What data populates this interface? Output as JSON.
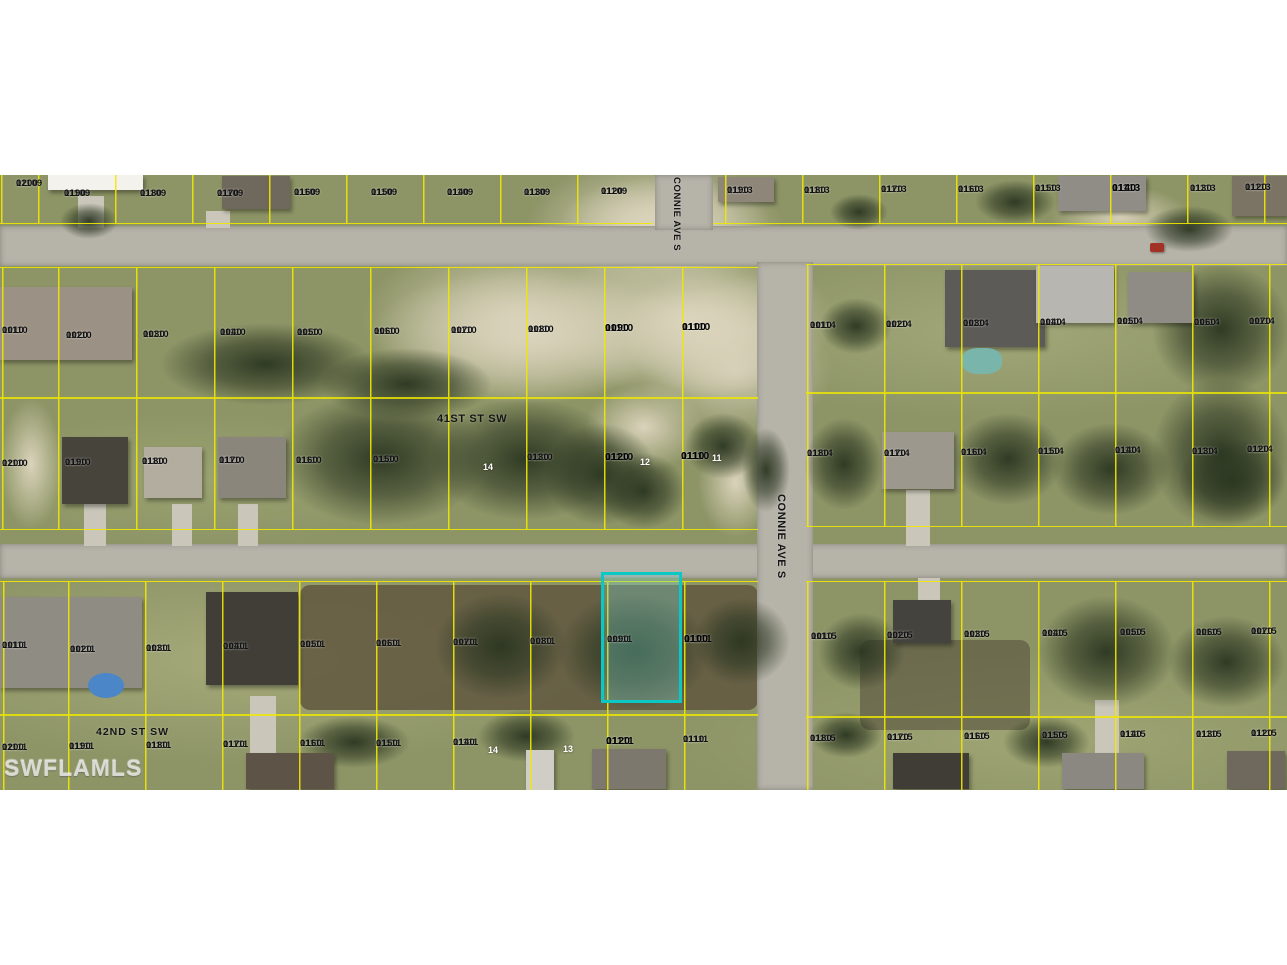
{
  "watermark": "SWFLAMLS",
  "streets": [
    {
      "name": "41ST ST SW"
    },
    {
      "name": "42ND ST SW"
    },
    {
      "name": "CONNIE AVE S"
    },
    {
      "name": "CONNIE AVE S"
    }
  ],
  "highlighted_parcel": {
    "id": "11110 0120",
    "outline_color": "#0bc8c4"
  },
  "colors": {
    "parcel_line": "#f0e900",
    "highlight": "#0bc8c4",
    "label_text": "#101010",
    "road": "#b6b3a9",
    "watermark_text": "#e6e6e0"
  },
  "parcels": [
    {
      "id": "11109 0200",
      "x": 16,
      "y": 179
    },
    {
      "id": "11109 0190",
      "x": 64,
      "y": 189
    },
    {
      "id": "11109 0180",
      "x": 140,
      "y": 189
    },
    {
      "id": "11109 0170",
      "x": 217,
      "y": 189
    },
    {
      "id": "11109 0160",
      "x": 294,
      "y": 188
    },
    {
      "id": "11109 0150",
      "x": 371,
      "y": 188
    },
    {
      "id": "11109 0140",
      "x": 447,
      "y": 188
    },
    {
      "id": "11109 0130",
      "x": 524,
      "y": 188
    },
    {
      "id": "11109 0120",
      "x": 601,
      "y": 187
    },
    {
      "id": "11113 0190",
      "x": 727,
      "y": 186
    },
    {
      "id": "11113 0180",
      "x": 804,
      "y": 186
    },
    {
      "id": "11113 0170",
      "x": 881,
      "y": 185
    },
    {
      "id": "11113 0160",
      "x": 958,
      "y": 185
    },
    {
      "id": "11113 0150",
      "x": 1035,
      "y": 184
    },
    {
      "id": "11113 0140",
      "x": 1112,
      "y": 183,
      "bold": true
    },
    {
      "id": "11113 0130",
      "x": 1190,
      "y": 184
    },
    {
      "id": "11113 0120",
      "x": 1245,
      "y": 183
    },
    {
      "id": "11110 0010",
      "x": 2,
      "y": 326
    },
    {
      "id": "11110 0020",
      "x": 66,
      "y": 331
    },
    {
      "id": "11110 0030",
      "x": 143,
      "y": 330
    },
    {
      "id": "11110 0040",
      "x": 220,
      "y": 328
    },
    {
      "id": "11110 0050",
      "x": 297,
      "y": 328
    },
    {
      "id": "11110 0060",
      "x": 374,
      "y": 327
    },
    {
      "id": "11110 0070",
      "x": 451,
      "y": 326
    },
    {
      "id": "11110 0080",
      "x": 528,
      "y": 325
    },
    {
      "id": "11110 0090",
      "x": 605,
      "y": 323,
      "bold": true
    },
    {
      "id": "11110 0100",
      "x": 682,
      "y": 322,
      "bold": true
    },
    {
      "id": "11114 0010",
      "x": 810,
      "y": 321
    },
    {
      "id": "11114 0020",
      "x": 886,
      "y": 320
    },
    {
      "id": "11114 0030",
      "x": 963,
      "y": 319
    },
    {
      "id": "11114 0040",
      "x": 1040,
      "y": 318
    },
    {
      "id": "11114 0050",
      "x": 1117,
      "y": 317
    },
    {
      "id": "11114 0060",
      "x": 1194,
      "y": 318
    },
    {
      "id": "11114 0070",
      "x": 1249,
      "y": 317
    },
    {
      "id": "11110 0200",
      "x": 2,
      "y": 459
    },
    {
      "id": "11110 0190",
      "x": 65,
      "y": 458
    },
    {
      "id": "11110 0180",
      "x": 142,
      "y": 457
    },
    {
      "id": "11110 0170",
      "x": 219,
      "y": 456
    },
    {
      "id": "11110 0160",
      "x": 296,
      "y": 456
    },
    {
      "id": "11110 0150",
      "x": 373,
      "y": 455
    },
    {
      "id": "11110 0130",
      "x": 527,
      "y": 453
    },
    {
      "id": "11110 0120",
      "x": 605,
      "y": 452,
      "bold": true
    },
    {
      "id": "11110 0110",
      "x": 681,
      "y": 451,
      "bold": true
    },
    {
      "id": "11114 0180",
      "x": 807,
      "y": 449
    },
    {
      "id": "11114 0170",
      "x": 884,
      "y": 449
    },
    {
      "id": "11114 0160",
      "x": 961,
      "y": 448
    },
    {
      "id": "11114 0150",
      "x": 1038,
      "y": 447
    },
    {
      "id": "11114 0140",
      "x": 1115,
      "y": 446
    },
    {
      "id": "11114 0130",
      "x": 1192,
      "y": 447
    },
    {
      "id": "11114 0120",
      "x": 1247,
      "y": 445
    },
    {
      "id": "11111 0010",
      "x": 2,
      "y": 641
    },
    {
      "id": "11111 0020",
      "x": 70,
      "y": 645
    },
    {
      "id": "11111 0030",
      "x": 146,
      "y": 644
    },
    {
      "id": "11111 0040",
      "x": 223,
      "y": 642
    },
    {
      "id": "11111 0050",
      "x": 300,
      "y": 640
    },
    {
      "id": "11111 0060",
      "x": 376,
      "y": 639
    },
    {
      "id": "11111 0070",
      "x": 453,
      "y": 638
    },
    {
      "id": "11111 0080",
      "x": 530,
      "y": 637
    },
    {
      "id": "11111 0090",
      "x": 607,
      "y": 635
    },
    {
      "id": "11111 0100",
      "x": 684,
      "y": 634,
      "bold": true
    },
    {
      "id": "11115 0010",
      "x": 811,
      "y": 632
    },
    {
      "id": "11115 0020",
      "x": 887,
      "y": 631
    },
    {
      "id": "11115 0030",
      "x": 964,
      "y": 630
    },
    {
      "id": "11115 0040",
      "x": 1042,
      "y": 629
    },
    {
      "id": "11115 0050",
      "x": 1120,
      "y": 628
    },
    {
      "id": "11115 0060",
      "x": 1196,
      "y": 628
    },
    {
      "id": "11115 0070",
      "x": 1251,
      "y": 627
    },
    {
      "id": "11111 0200",
      "x": 2,
      "y": 743
    },
    {
      "id": "11111 0190",
      "x": 69,
      "y": 742
    },
    {
      "id": "11111 0180",
      "x": 146,
      "y": 741
    },
    {
      "id": "11111 0170",
      "x": 223,
      "y": 740
    },
    {
      "id": "11111 0160",
      "x": 300,
      "y": 739
    },
    {
      "id": "11111 0150",
      "x": 376,
      "y": 739
    },
    {
      "id": "11111 0140",
      "x": 453,
      "y": 738
    },
    {
      "id": "11111 0120",
      "x": 606,
      "y": 736,
      "bold": true
    },
    {
      "id": "11111 0110",
      "x": 683,
      "y": 735
    },
    {
      "id": "11115 0180",
      "x": 810,
      "y": 734
    },
    {
      "id": "11115 0170",
      "x": 887,
      "y": 733
    },
    {
      "id": "11115 0160",
      "x": 964,
      "y": 732
    },
    {
      "id": "11115 0150",
      "x": 1042,
      "y": 731
    },
    {
      "id": "11115 0140",
      "x": 1120,
      "y": 730
    },
    {
      "id": "11115 0130",
      "x": 1196,
      "y": 730
    },
    {
      "id": "11115 0120",
      "x": 1251,
      "y": 729
    }
  ],
  "lot_numbers": [
    {
      "n": "14",
      "x": 483,
      "y": 462
    },
    {
      "n": "12",
      "x": 640,
      "y": 457
    },
    {
      "n": "11",
      "x": 712,
      "y": 453
    },
    {
      "n": "14",
      "x": 488,
      "y": 745
    },
    {
      "n": "13",
      "x": 563,
      "y": 744
    }
  ]
}
